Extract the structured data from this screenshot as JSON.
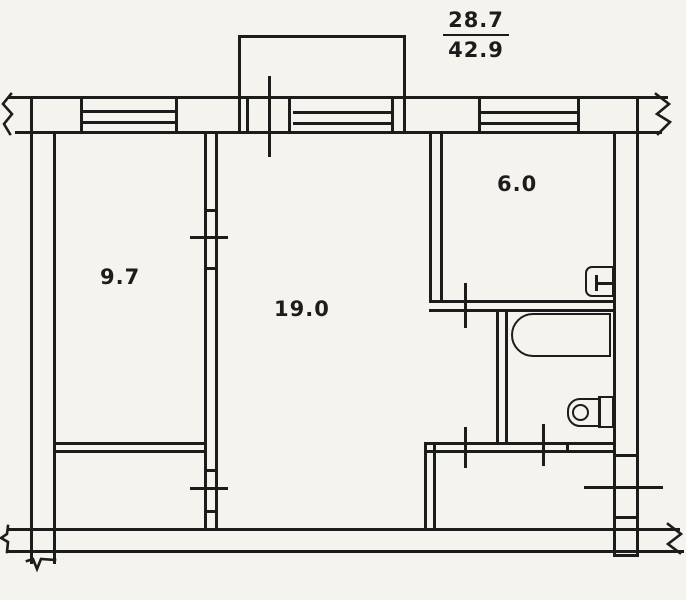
{
  "plan": {
    "area_fraction": {
      "numerator": "28.7",
      "denominator": "42.9"
    },
    "rooms": [
      {
        "id": "room-9-7",
        "area": "9.7"
      },
      {
        "id": "room-19-0",
        "area": "19.0"
      },
      {
        "id": "kitchen",
        "area": "6.0"
      }
    ],
    "fixtures": [
      "bathtub-icon",
      "toilet-icon",
      "kitchen-sink-icon"
    ],
    "colors": {
      "ink": "#1c1c1c",
      "paper": "#f5f3ee"
    }
  }
}
